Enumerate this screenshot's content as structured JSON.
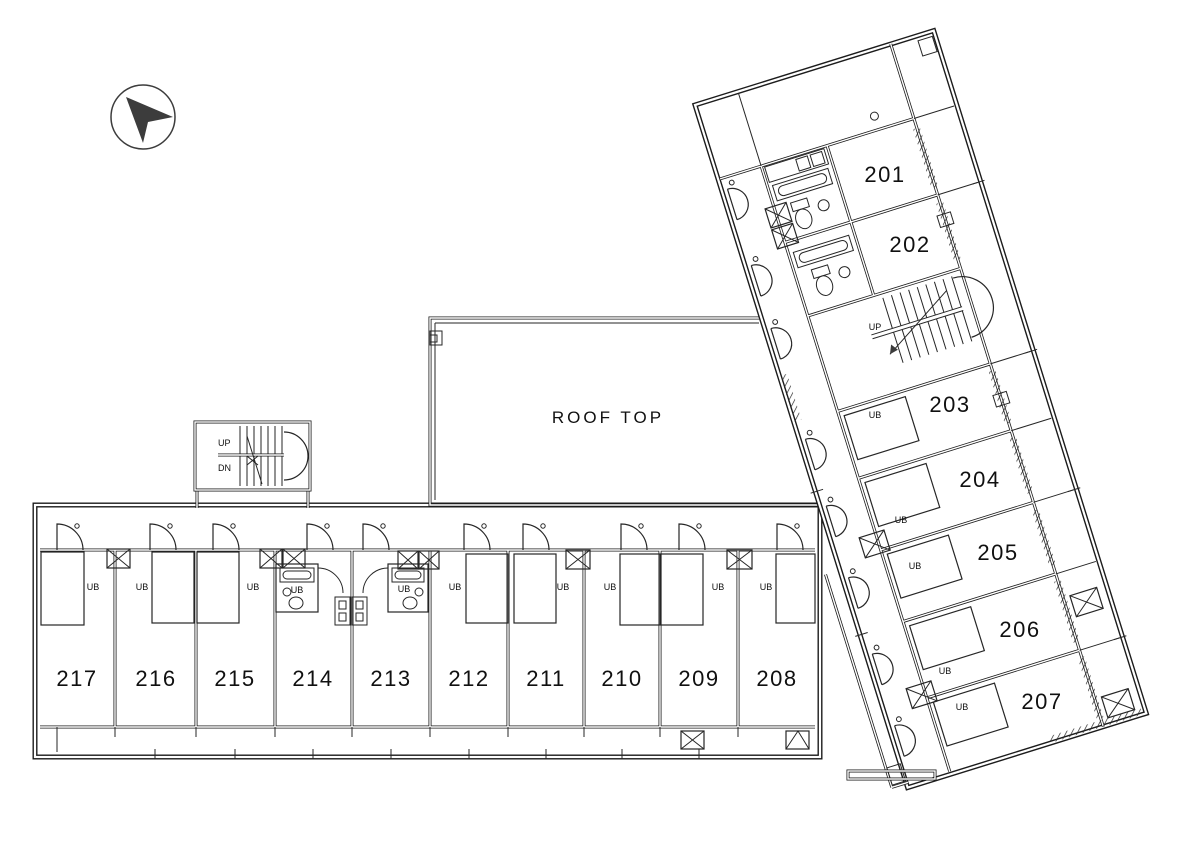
{
  "compass": {
    "icon": "north-arrow"
  },
  "labels": {
    "roof_top": "ROOF TOP",
    "up": "UP",
    "down": "DN",
    "unit_bath": "UB"
  },
  "wing_a_rooms": [
    "201",
    "202",
    "203",
    "204",
    "205",
    "206",
    "207"
  ],
  "wing_b_rooms": [
    "217",
    "216",
    "215",
    "214",
    "213",
    "212",
    "211",
    "210",
    "209",
    "208"
  ]
}
